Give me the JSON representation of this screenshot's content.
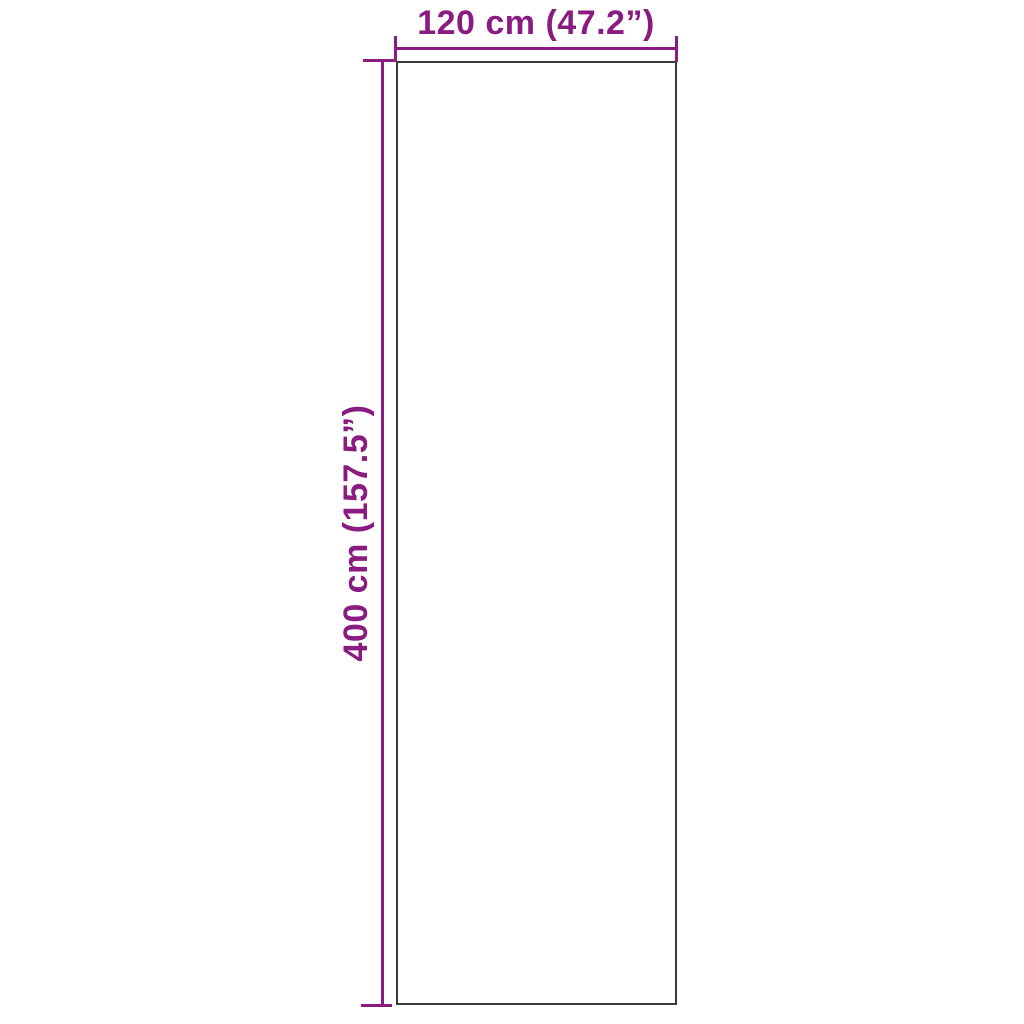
{
  "colors": {
    "dimension_accent": "#8a1b80",
    "product_outline": "#3a3a3a",
    "background": "#ffffff"
  },
  "dimensions": {
    "width": {
      "label": "120 cm (47.2”)",
      "cm": 120,
      "inches": 47.2
    },
    "height": {
      "label": "400 cm (157.5”)",
      "cm": 400,
      "inches": 157.5
    }
  }
}
